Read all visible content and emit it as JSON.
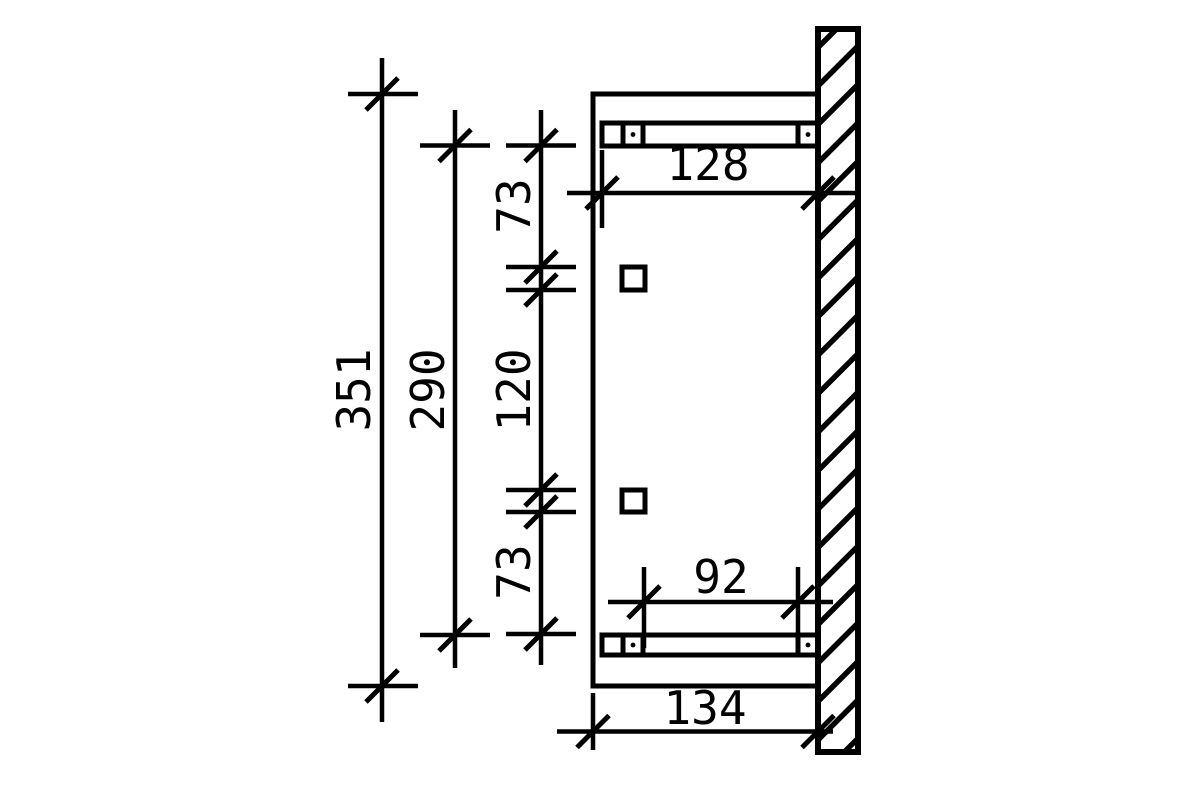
{
  "dimensions": {
    "total_height": "351",
    "inner_height": "290",
    "chain_top": "73",
    "chain_middle": "120",
    "chain_bottom": "73",
    "top_beam_length": "128",
    "bottom_beam_clear_span": "92",
    "bottom_total_depth": "134"
  },
  "colors": {
    "line": "#000000",
    "background": "#ffffff"
  }
}
